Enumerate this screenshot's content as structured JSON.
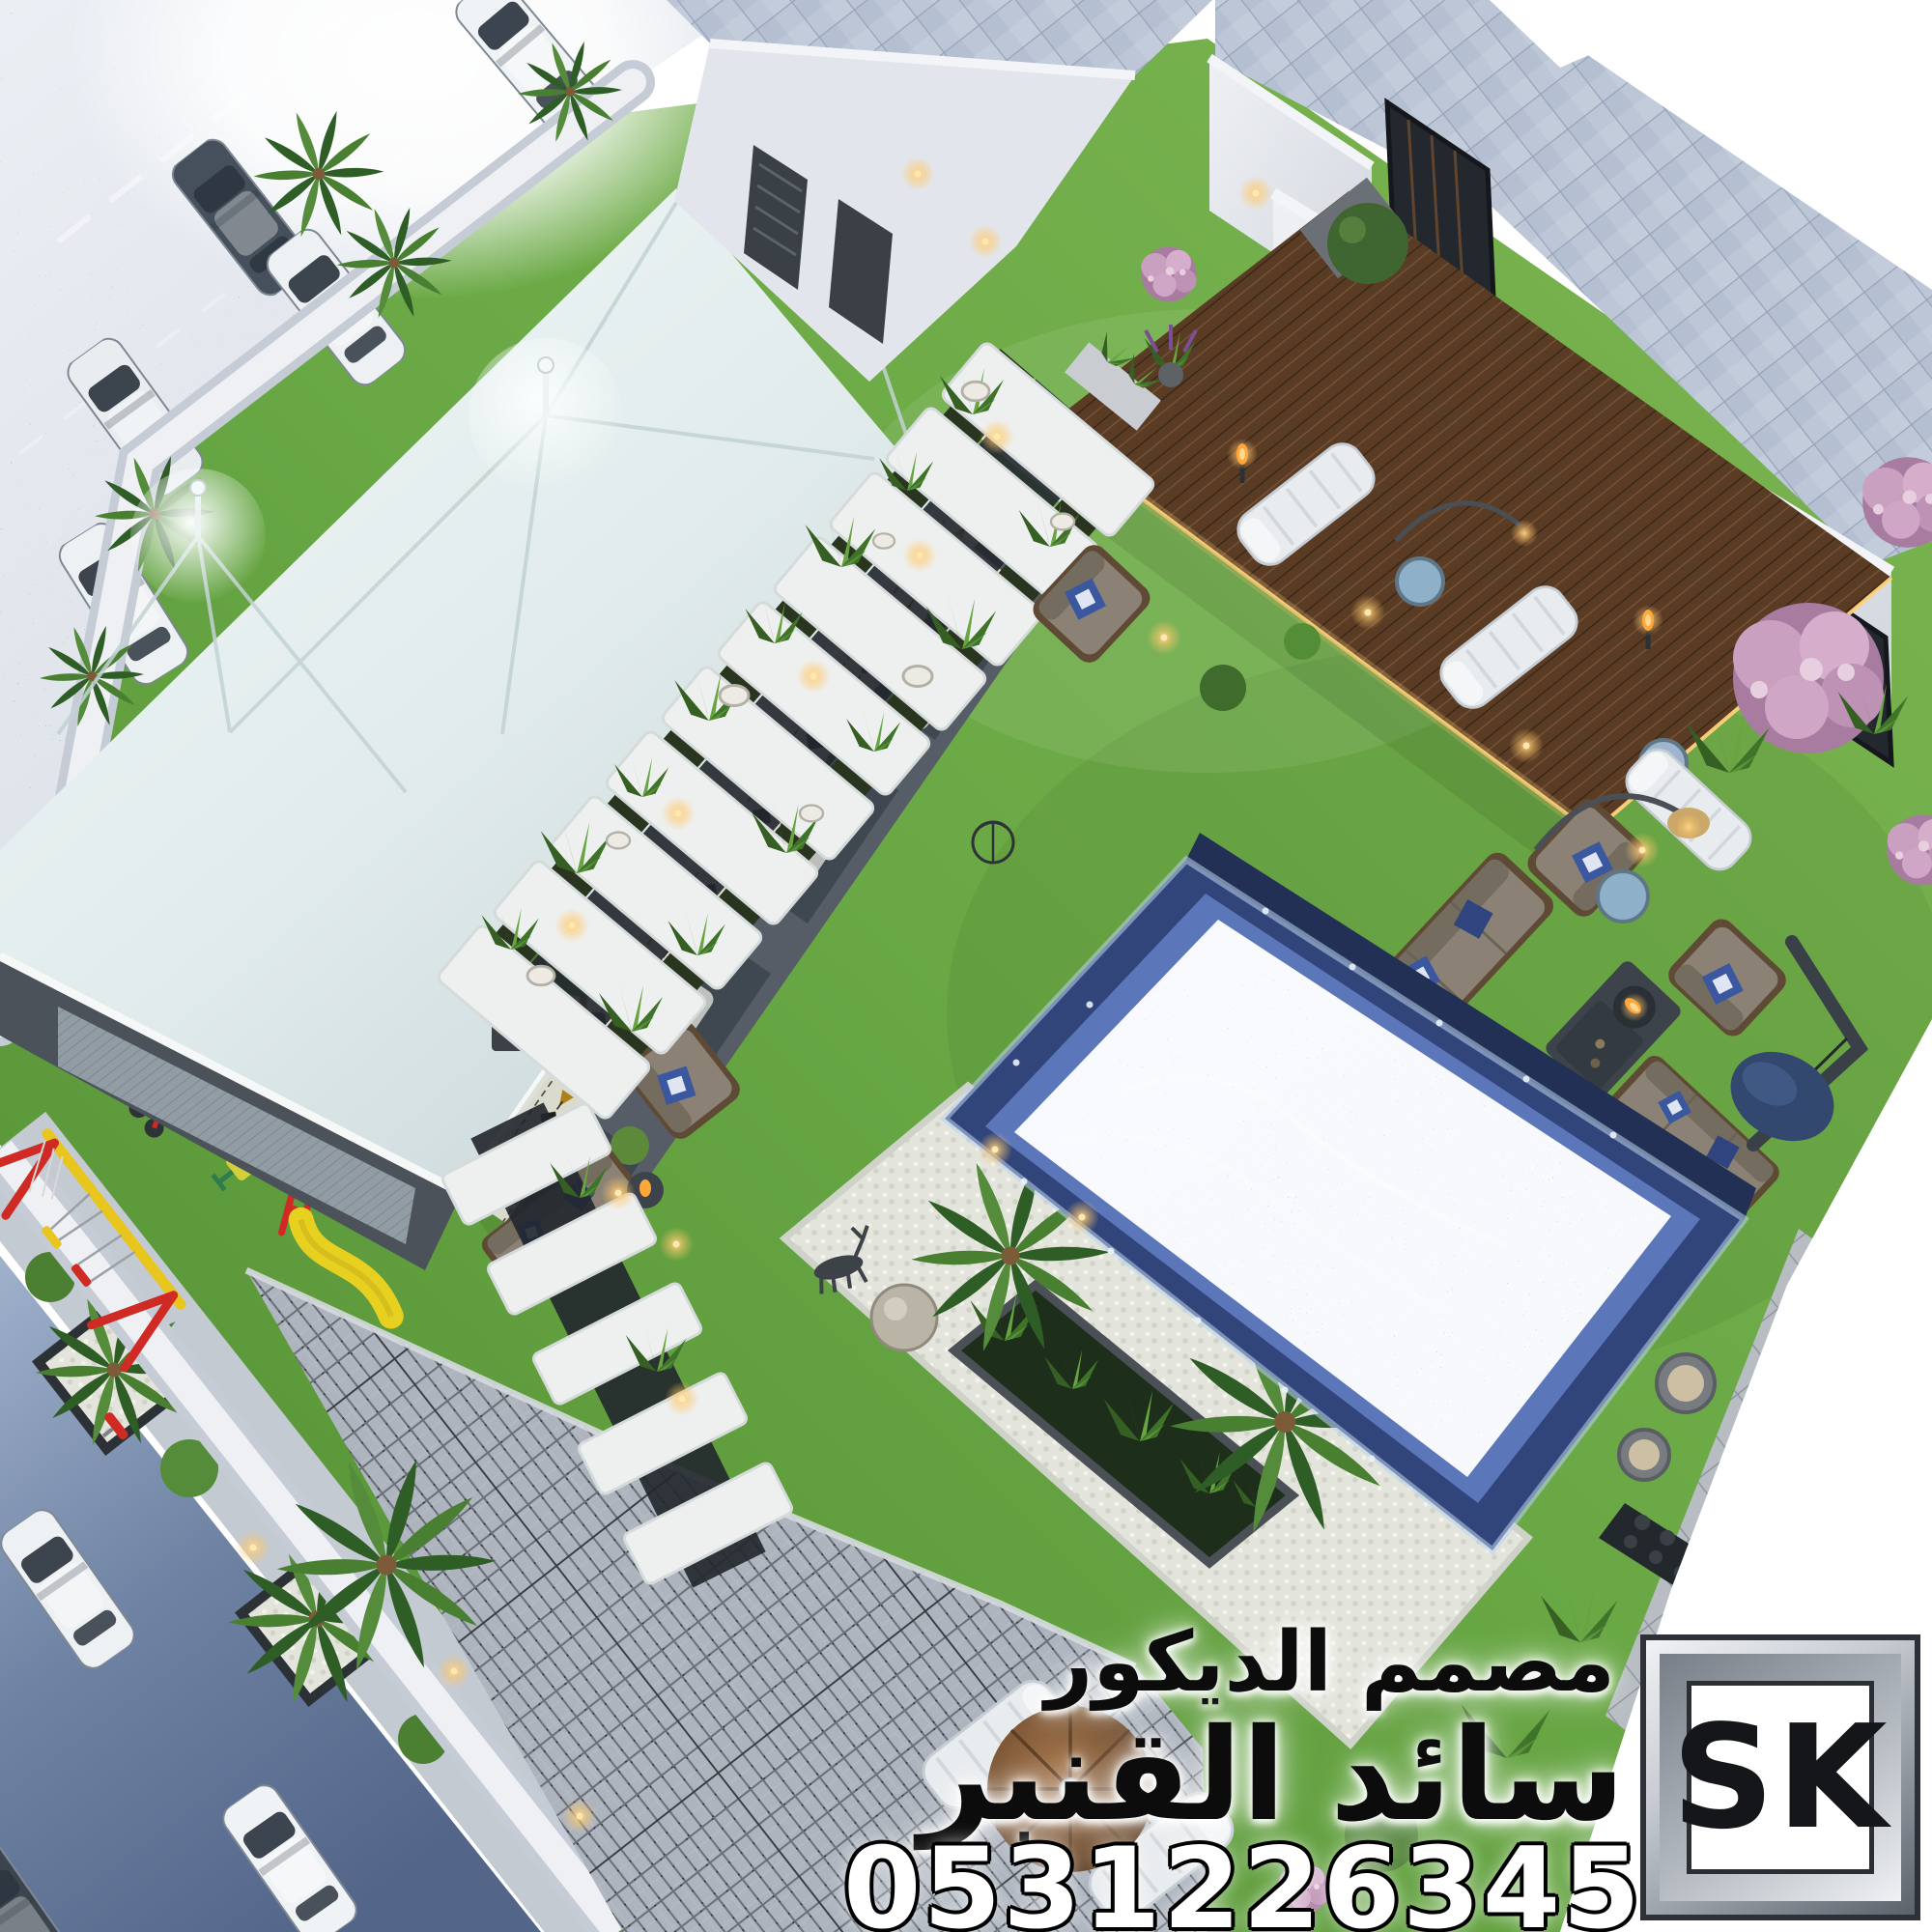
{
  "watermark": {
    "line1": "مصمم الديكور",
    "line2": "سائد القنبر",
    "phone": "0531226345"
  },
  "logo": {
    "text": "SK"
  },
  "colors": {
    "grass": "#69a845",
    "grassDeep": "#4f8a31",
    "street": "#5d7191",
    "streetLight": "#93a6c2",
    "wall": "#eceef2",
    "wallShade": "#c5ccd6",
    "tent": "#e7efef",
    "tentShade": "#c6d4d6",
    "frame": "#545b64",
    "sadu": "#f5f2e8",
    "saduGold": "#c08a1e",
    "roofTile": "#bcc6d6",
    "deckWood": "#5a3c25",
    "marble": "#eef0ef",
    "paver": "#b2b9c3",
    "pebble": "#e3e4db",
    "pool": "#7e96d8",
    "poolDeep": "#31457a",
    "pillow": "#3a57a0",
    "sofa": "#8b8275",
    "flame": "#ffa73a",
    "playRed": "#cf2b24",
    "playYellow": "#e8c61e",
    "pink": "#c9a0bf",
    "white": "#ffffff"
  }
}
